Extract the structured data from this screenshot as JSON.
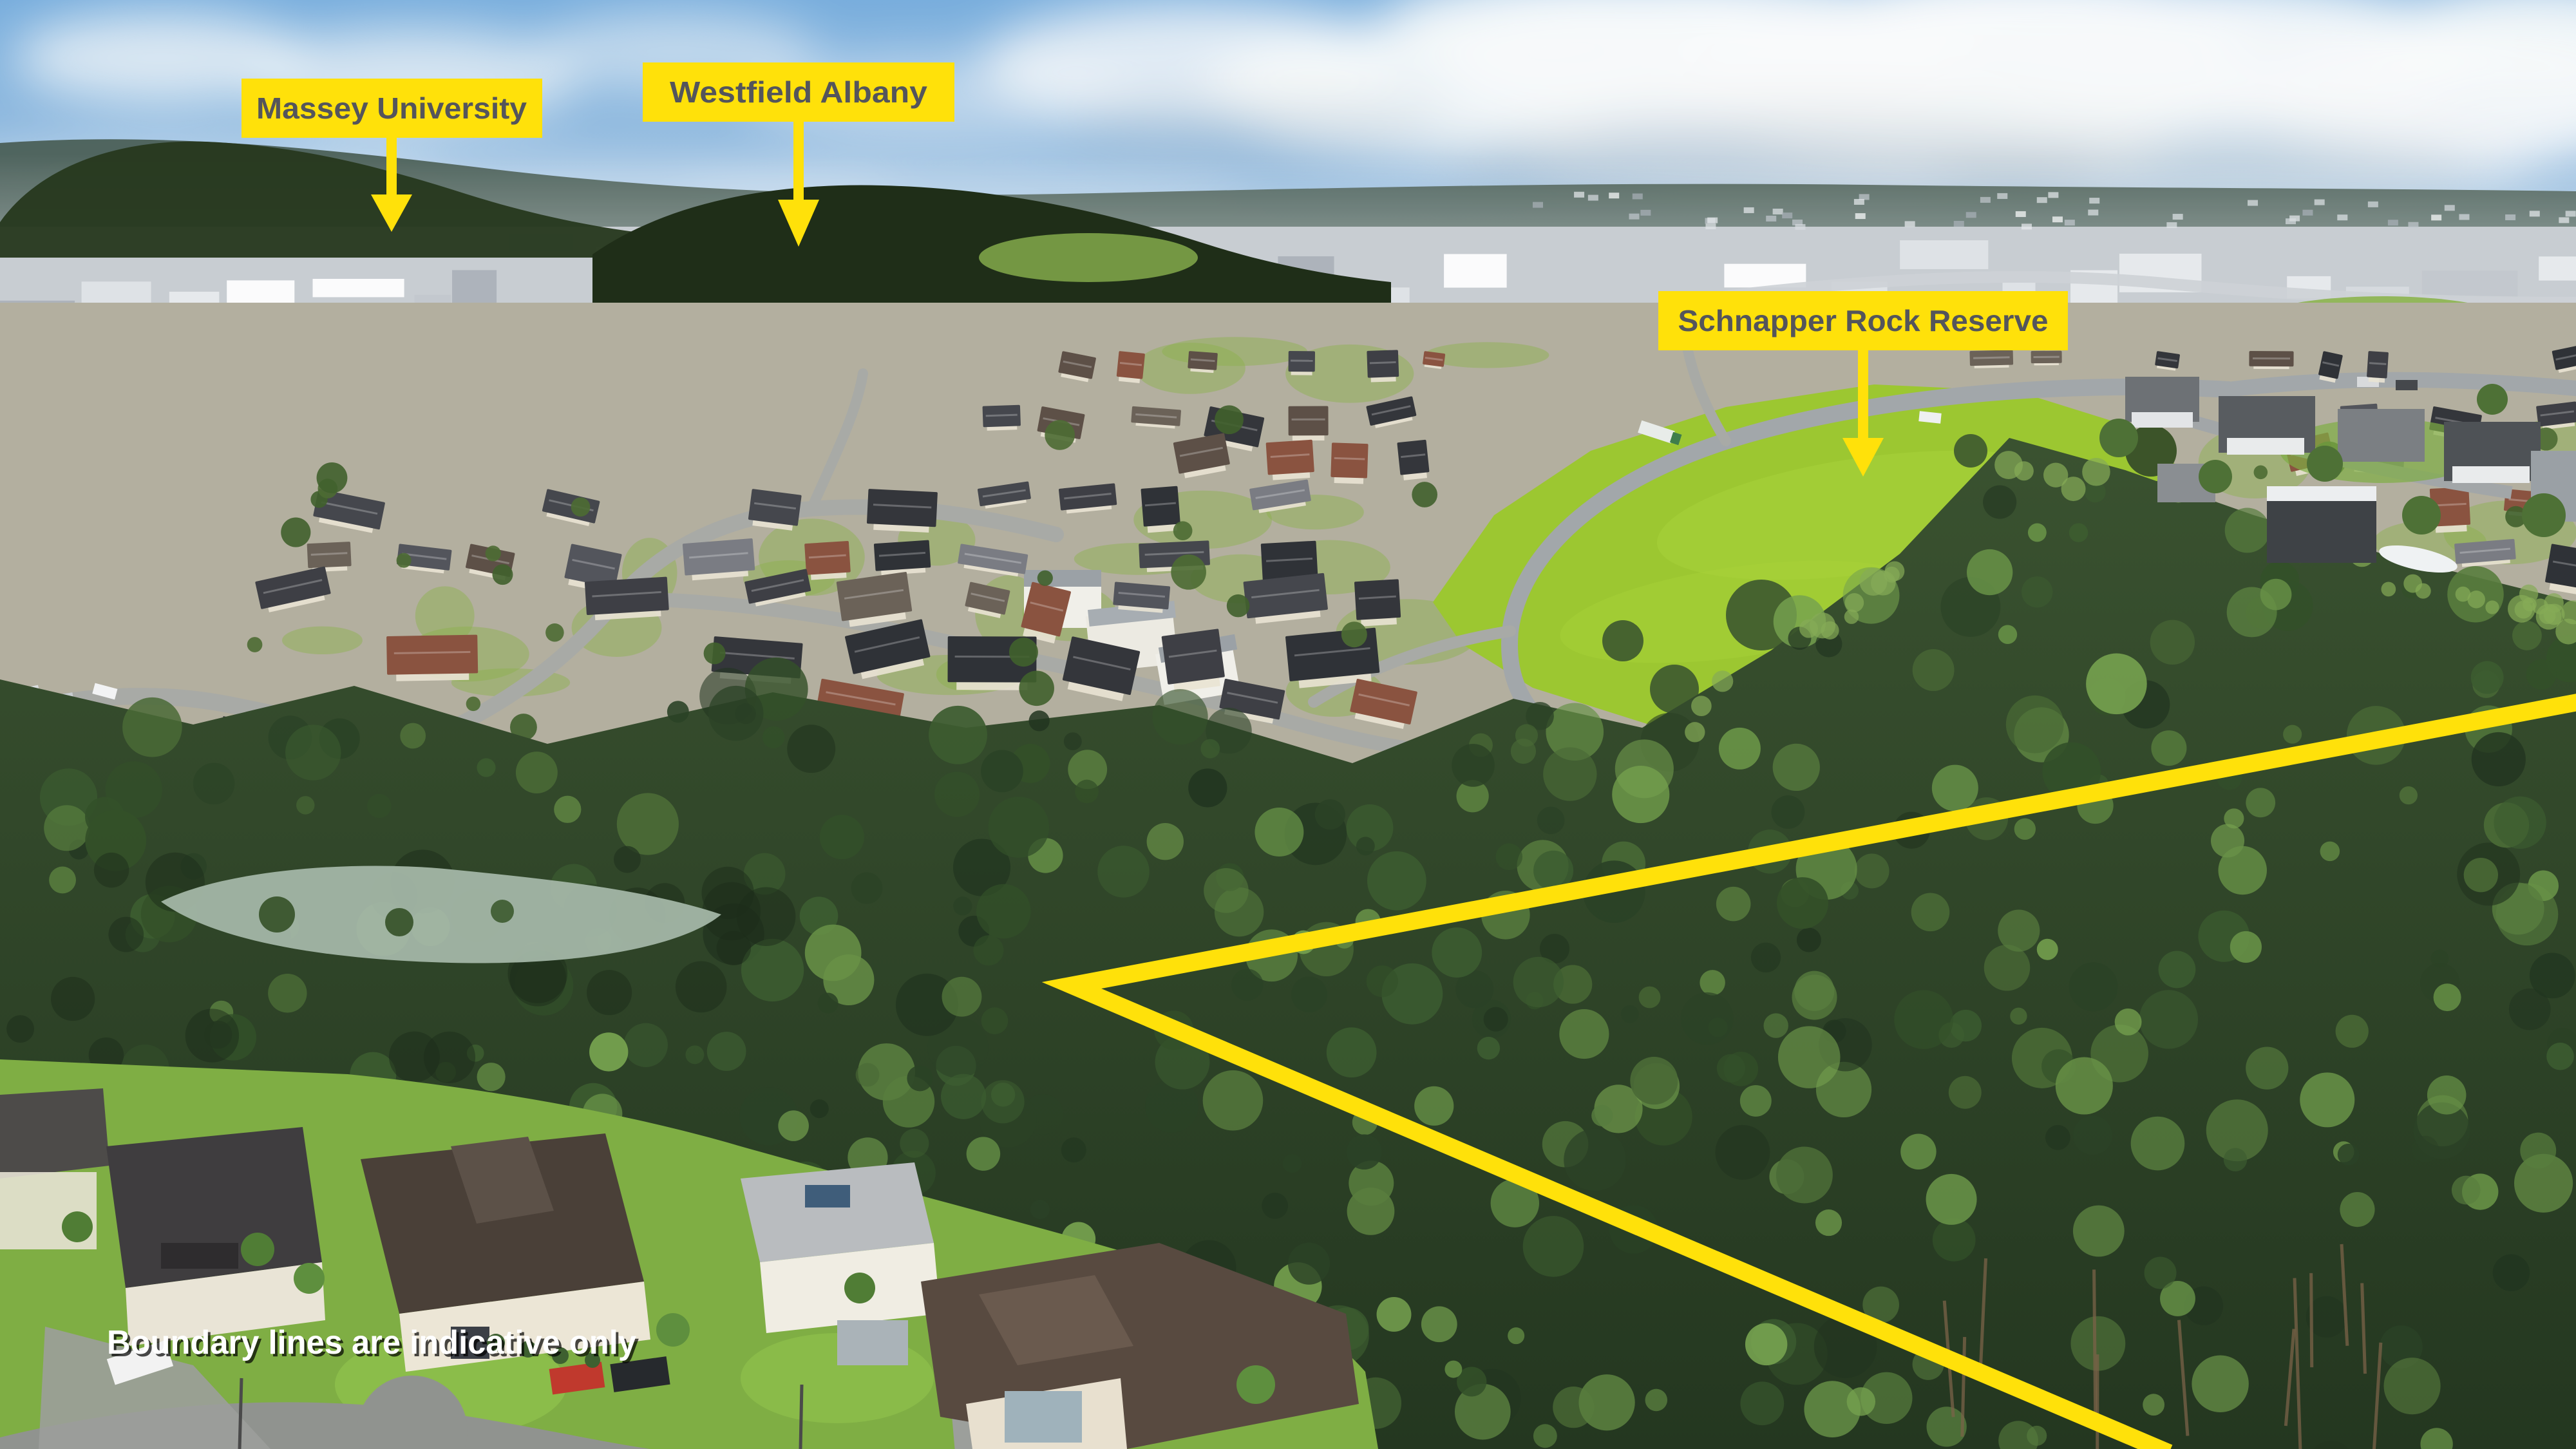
{
  "annotations": {
    "labels": [
      {
        "text": "Massey University",
        "arrow": "down"
      },
      {
        "text": "Westfield Albany",
        "arrow": "down"
      },
      {
        "text": "Schnapper Rock Reserve",
        "arrow": "down"
      }
    ],
    "disclaimer": "Boundary lines are indicative only"
  },
  "colors": {
    "annotation_yellow": "#FFE10A",
    "annotation_text": "#54555B",
    "boundary_line": "#FFE10A",
    "disclaimer_text": "#FFFFFF"
  }
}
